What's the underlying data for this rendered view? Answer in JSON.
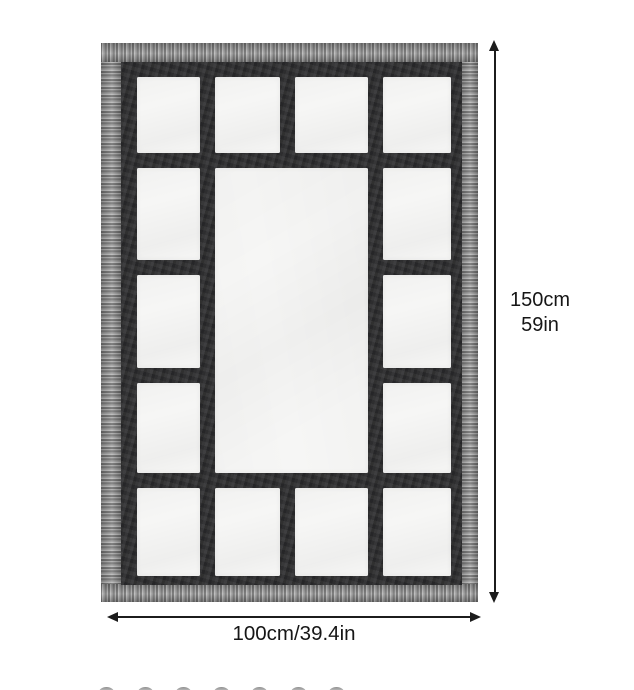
{
  "diagram": {
    "height_dimension": {
      "line1": "150cm",
      "line2": "59in"
    },
    "width_dimension": "100cm/39.4in",
    "blanket": {
      "grid_rows": 5,
      "grid_columns": 4,
      "total_panels": 15,
      "center_panel_span": "2 columns x 3 rows",
      "frame_color": "#2e2e30",
      "panel_color": "#f6f6f5",
      "fringe_color_light": "#cfcfcf",
      "fringe_color_dark": "#3a3a3a"
    },
    "annotation_color": "#1c1c1c",
    "cropped_thumbnail_count": 7
  }
}
